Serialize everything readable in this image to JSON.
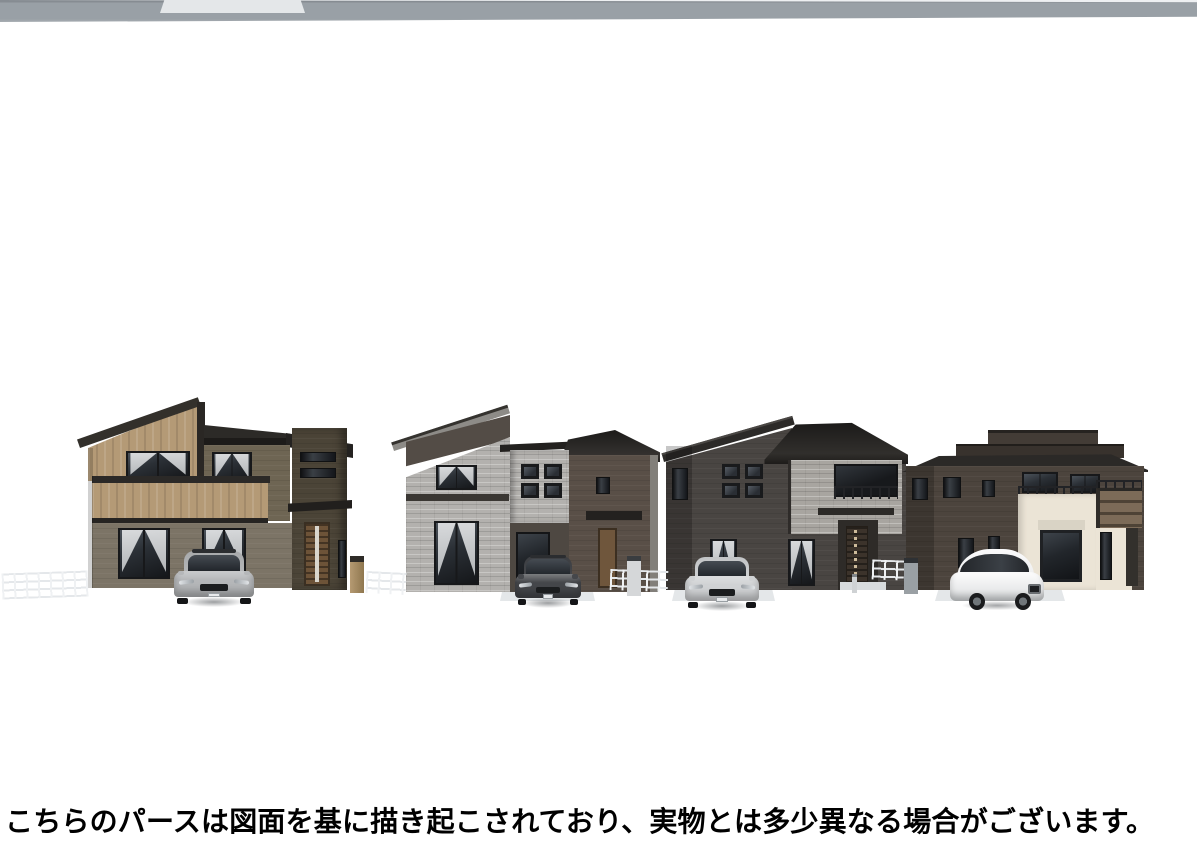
{
  "image": {
    "type": "architectural-perspective-rendering",
    "subject": "Row of four newly built two-story houses with a car parked in front of each"
  },
  "caption": {
    "text": "こちらのパースは図面を基に描き起こされており、実物とは多少異なる場合がございます。"
  },
  "scene": {
    "houses": [
      {
        "name": "house-1",
        "accent": "tan wood gable and balcony, olive siding",
        "car": "silver hatchback"
      },
      {
        "name": "house-2",
        "accent": "mono-pitch roof, gray stone cladding",
        "car": "dark gray wagon"
      },
      {
        "name": "house-3",
        "accent": "charcoal siding, stone balcony",
        "car": "silver sedan"
      },
      {
        "name": "house-4",
        "accent": "flat parapet roof, cream and dark brown walls",
        "car": "white sedan"
      }
    ]
  },
  "palette": {
    "bg": "#ffffff",
    "captioncolor": "#000000",
    "roof": "#2b2927",
    "h1wood": "#b49a76",
    "h1wall": "#6e6553",
    "h1wall2": "#7c7466",
    "h1tower": "#4b4437",
    "h1door": "#6d5338",
    "h2fascia": "#8d8b87",
    "h2wall": "#594f47",
    "h2band": "#534c46",
    "h2stone": "#b3b1ae",
    "h2door": "#6f563c",
    "h3wall": "#494542",
    "h3stone": "#a8a5a0",
    "h3door": "#3c332b",
    "h4wall": "#4c443d",
    "h4cream": "#ebe4d6",
    "h4balcony": "#7c6b58",
    "lots": "#e9ebed",
    "sidewalk": "#d8dcdf",
    "curbc": "#eef0f2",
    "roadc": "#99a0a6",
    "car1": "#b5b7b9",
    "car1cab": "#a7a9ab",
    "car2": "#45474b",
    "car2cab": "#3c3e42",
    "car3": "#d0d2d4",
    "car3cab": "#c2c4c6",
    "car4": "#ecedee"
  }
}
